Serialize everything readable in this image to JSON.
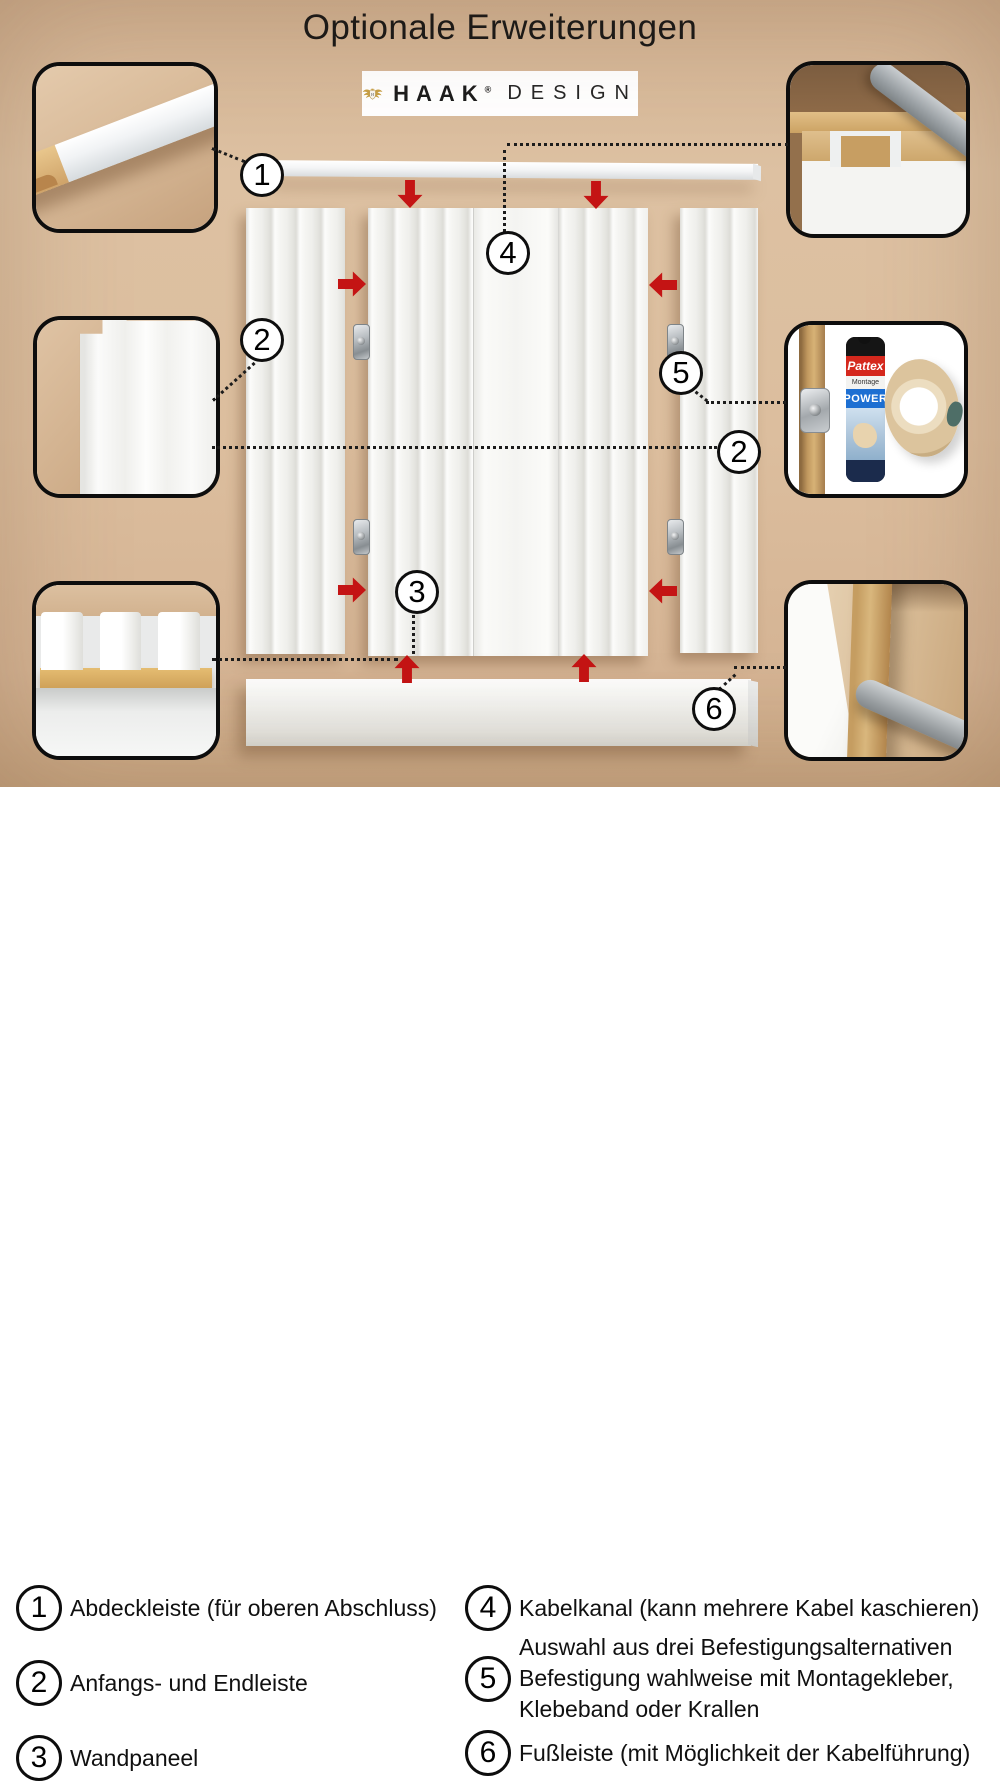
{
  "title": "Optionale Erweiterungen",
  "logo": {
    "crest_letter": "H",
    "brand": "HAAK",
    "registered": "®",
    "wordmark_suffix": "DESIGN"
  },
  "diagram": {
    "background_color": "#dcbe9e",
    "arrow_color": "#c41414",
    "callouts": [
      {
        "id": "abdeckleiste",
        "num": "1"
      },
      {
        "id": "endleiste-links",
        "num": "2"
      },
      {
        "id": "wandpaneel",
        "num": "3"
      },
      {
        "id": "kabelkanal",
        "num": "4"
      },
      {
        "id": "befestigung",
        "num": "5"
      },
      {
        "id": "endleiste-rechts",
        "num": "2"
      },
      {
        "id": "fussleiste",
        "num": "6"
      }
    ],
    "products": {
      "glue_brand": "Pattex",
      "glue_line": "Montage",
      "glue_variant": "POWER"
    }
  },
  "legend": {
    "items": [
      {
        "num": "1",
        "lines": [
          "Abdeckleiste (für oberen Abschluss)"
        ]
      },
      {
        "num": "2",
        "lines": [
          "Anfangs- und Endleiste"
        ]
      },
      {
        "num": "3",
        "lines": [
          "Wandpaneel"
        ]
      },
      {
        "num": "4",
        "lines": [
          "Kabelkanal (kann mehrere Kabel kaschieren)"
        ]
      },
      {
        "num": "5",
        "lines": [
          "Auswahl aus drei Befestigungsalternativen",
          "Befestigung wahlweise mit Montagekleber,",
          "Klebeband oder Krallen"
        ]
      },
      {
        "num": "6",
        "lines": [
          "Fußleiste (mit Möglichkeit der Kabelführung)"
        ]
      }
    ]
  }
}
